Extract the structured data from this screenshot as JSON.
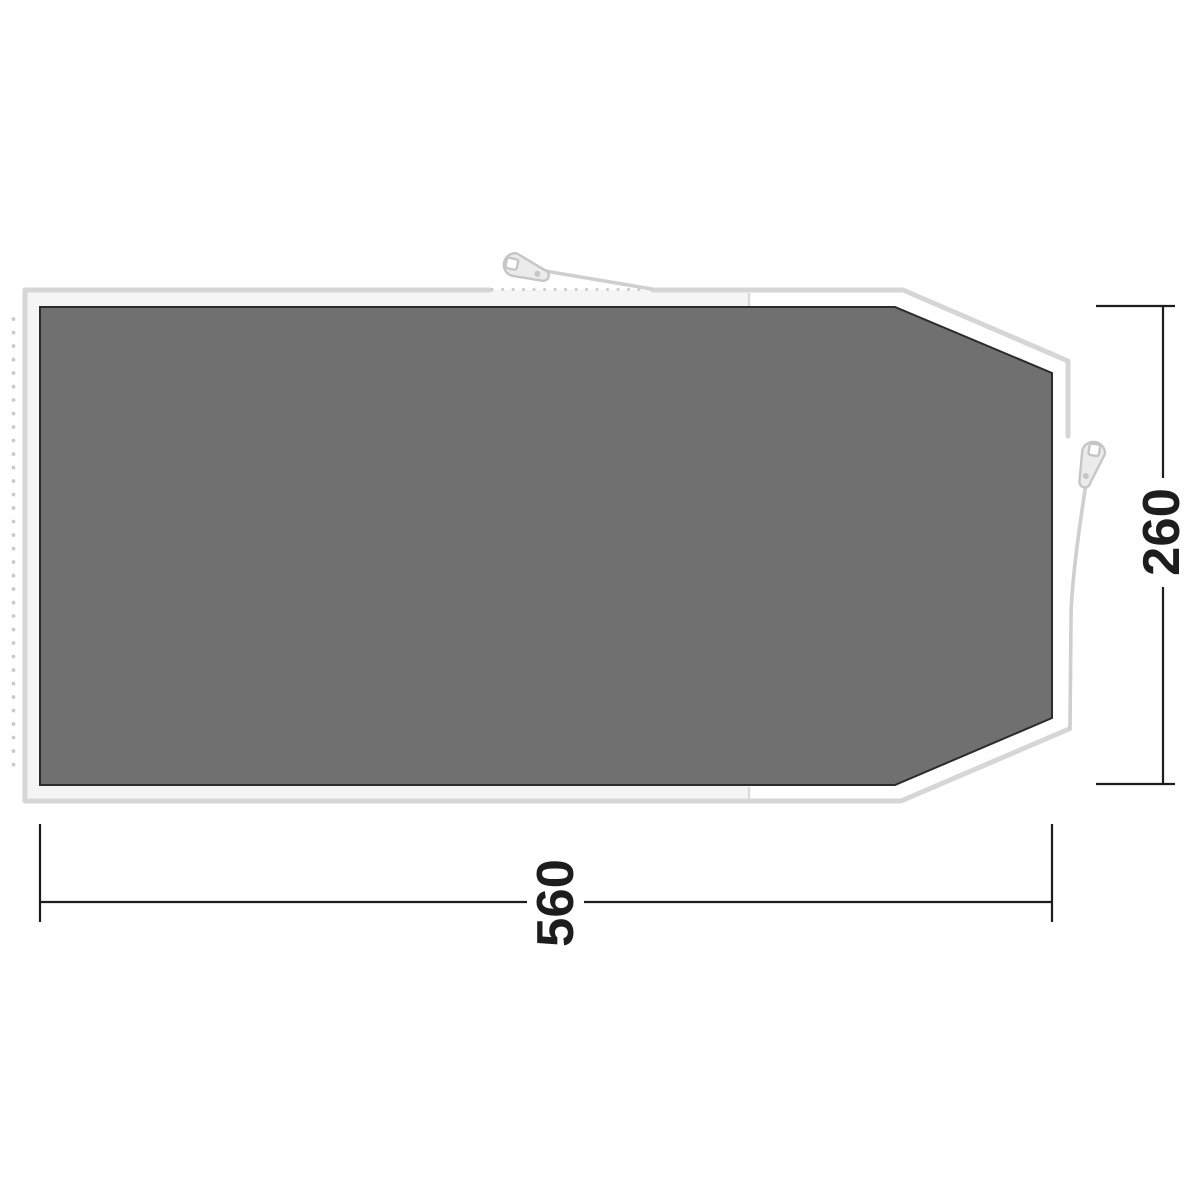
{
  "diagram": {
    "dimensions": {
      "width_label": "560",
      "depth_label": "260"
    },
    "colors": {
      "background": "#ffffff",
      "floor_fill": "#707070",
      "floor_border": "#2b2b2b",
      "groundsheet_outline": "#d6d6d6",
      "groundsheet_fill_inner": "#f5f5f5",
      "groundsheet_fill_front": "#ffffff",
      "seam_line": "#dadada",
      "dotted_line": "#cbcbcb",
      "guy_line": "#cfcfcf",
      "peg_fill": "#ebebeb",
      "peg_stroke": "#c6c6c6",
      "peg_hole_fill": "#ffffff",
      "dimension_line": "#1d1d1d",
      "dimension_text": "#1d1d1d"
    },
    "icons": {
      "peg": "tent-peg-icon"
    }
  }
}
